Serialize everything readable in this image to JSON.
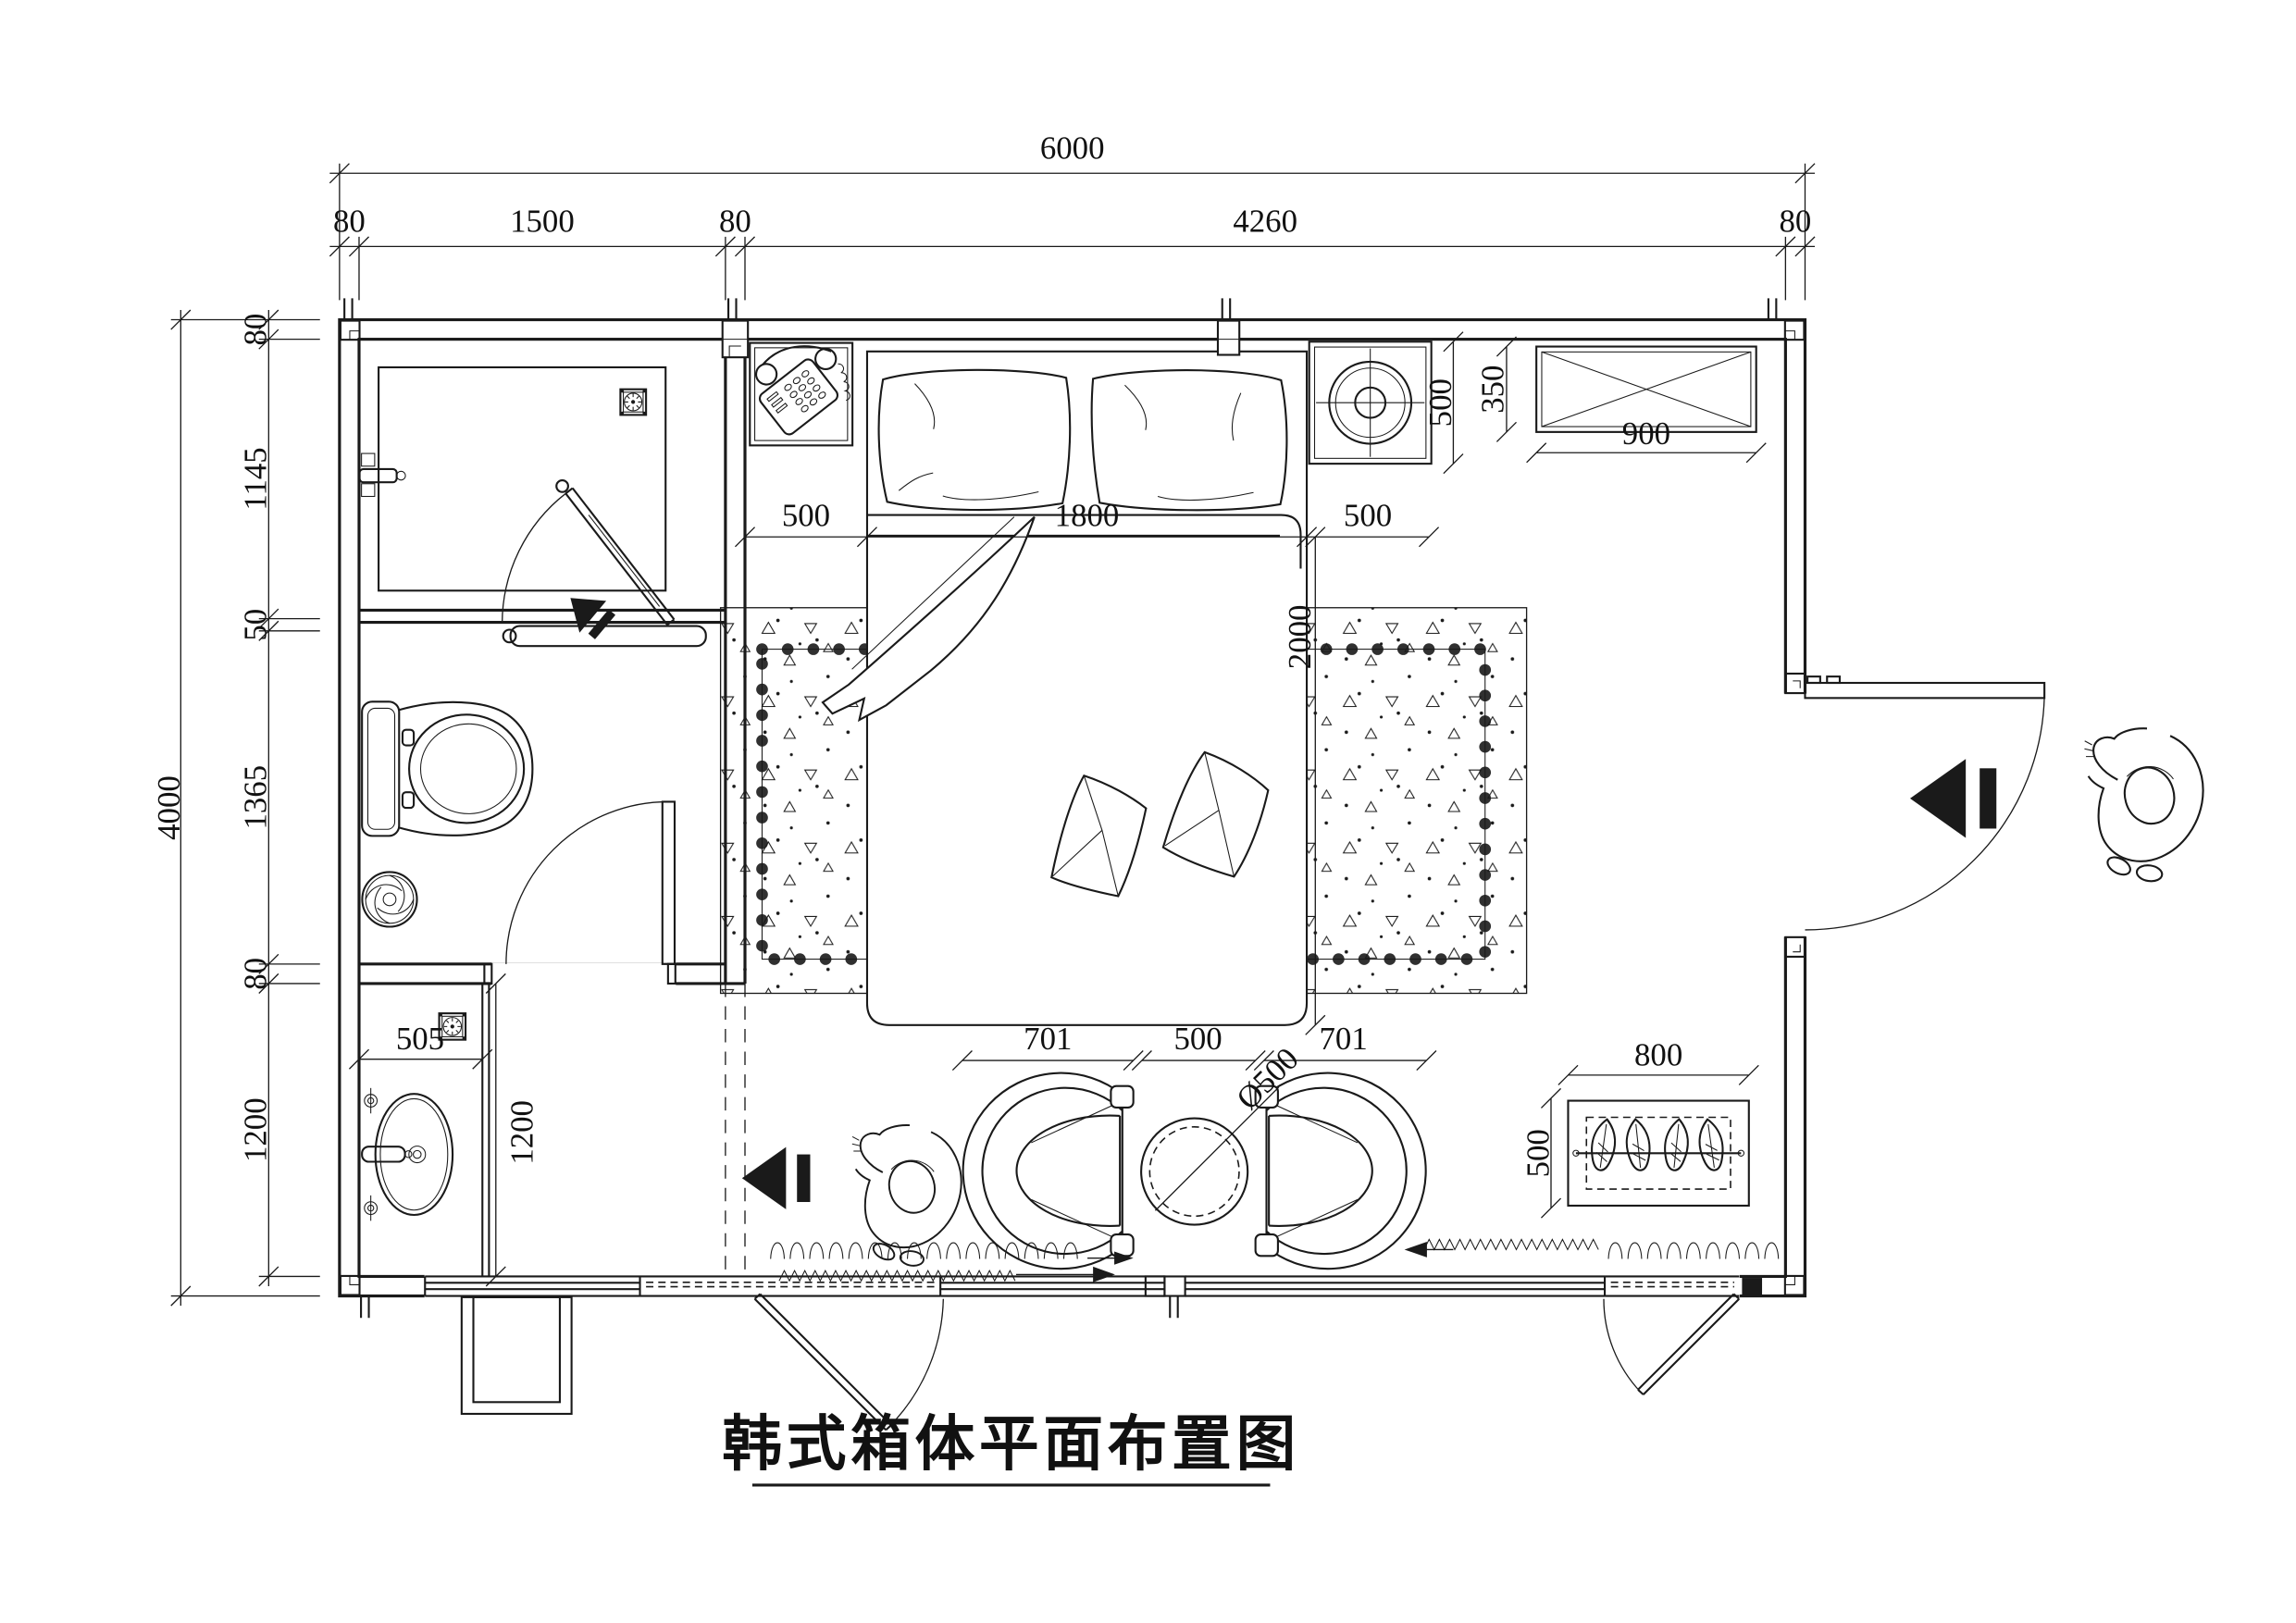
{
  "title": {
    "text": "韩式箱体平面布置图"
  },
  "dimensions": {
    "top_total": "6000",
    "top_chain": [
      "80",
      "1500",
      "80",
      "4260",
      "80"
    ],
    "left_total": "4000",
    "left_chain": [
      "80",
      "1145",
      "50",
      "1365",
      "80",
      "1200"
    ],
    "bed": {
      "left_offset": "500",
      "width": "1800",
      "right_offset": "500",
      "length": "2000"
    },
    "nightstand_right_depth": "500",
    "cabinet": {
      "width": "900",
      "depth": "350"
    },
    "vanity": {
      "width": "505",
      "length": "1200"
    },
    "seating": {
      "chair_left": "701",
      "table_gap": "500",
      "chair_right": "701",
      "table_diameter": "Ø500"
    },
    "planter": {
      "width": "800",
      "depth": "500"
    }
  },
  "colors": {
    "line": "#1a1a1a",
    "background": "#ffffff"
  }
}
